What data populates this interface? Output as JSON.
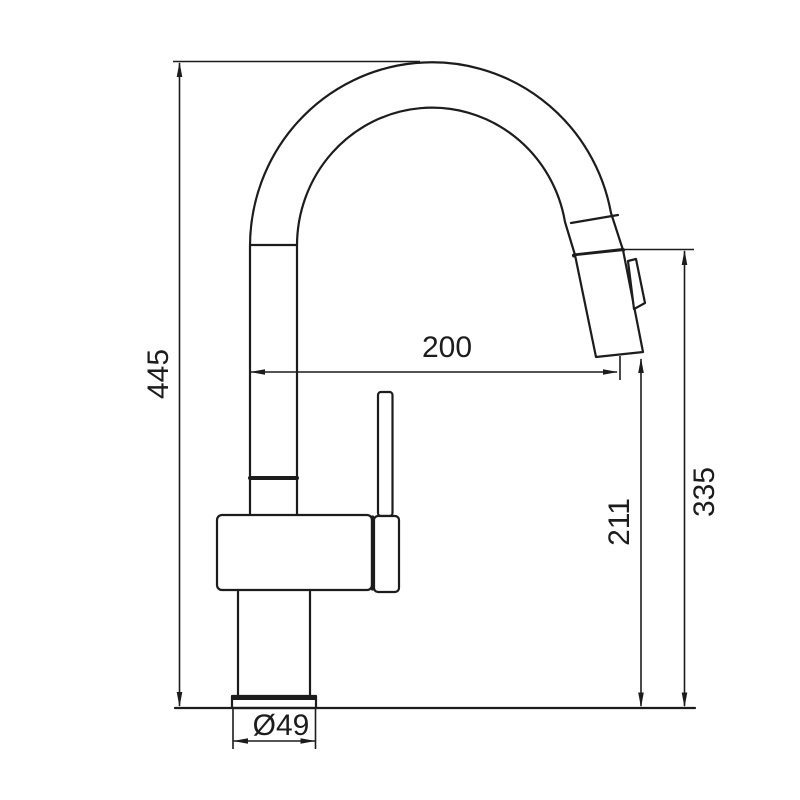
{
  "page": {
    "background_color": "#ffffff"
  },
  "drawing": {
    "line_color": "#1c1c1c"
  },
  "dims": {
    "overall_height": "445",
    "spout_reach": "200",
    "outlet_height": "211",
    "spout_height": "335",
    "base_diameter": "Ø49"
  }
}
